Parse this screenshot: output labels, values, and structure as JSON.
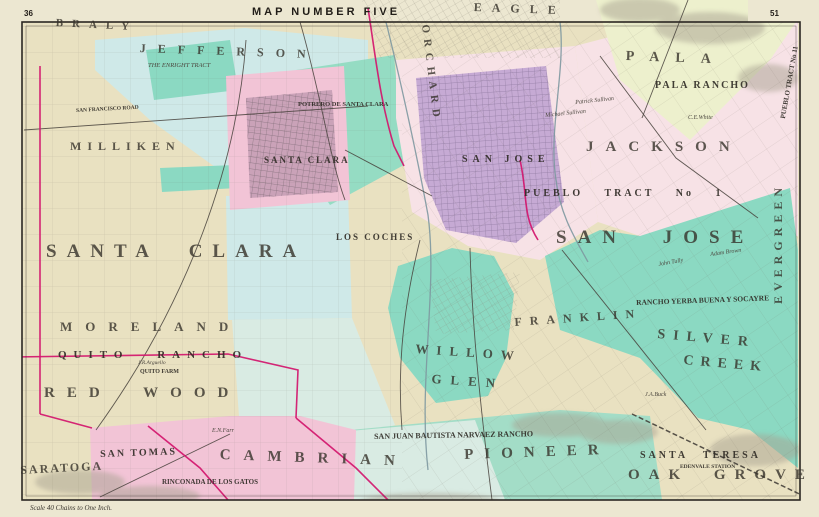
{
  "sheet": {
    "title": "MAP NUMBER FIVE",
    "page_number_left": "36",
    "page_number_right": "51",
    "scale_note": "Scale 40 Chains to One Inch."
  },
  "colors": {
    "margin": "#ece7d1",
    "cream": "#e9e1c1",
    "blue": "#cfe9e8",
    "blue2": "#d9ebe3",
    "teal": "#8bd9c2",
    "teal2": "#a3ddc7",
    "green": "#95dcc3",
    "palegreen": "#edf0cd",
    "pink": "#f2c4d6",
    "pinkpale": "#f7e2e6",
    "purple": "#c6aad4",
    "magenta": "#d3156d",
    "ink": "#2b2722",
    "road": "#45403a",
    "river": "#7d98a0",
    "hill": "#a8a291",
    "citygrid_pink": "#6d6068",
    "citygrid_purple": "#837095"
  },
  "labels": [
    {
      "id": "township-braly",
      "text": "BRALY",
      "x": 56,
      "y": 18,
      "s": 11,
      "ls": 9,
      "rot": 3,
      "cat": "twp"
    },
    {
      "id": "township-jefferson",
      "text": "JEFFERSON",
      "x": 140,
      "y": 42,
      "s": 12,
      "ls": 12,
      "rot": 2,
      "cat": "twp"
    },
    {
      "id": "township-eagle",
      "text": "EAGLE",
      "x": 474,
      "y": 1,
      "s": 12,
      "ls": 10,
      "rot": 2,
      "cat": "twp"
    },
    {
      "id": "township-pala",
      "text": "PALA",
      "x": 626,
      "y": 50,
      "s": 14,
      "ls": 16,
      "rot": 2,
      "cat": "twp"
    },
    {
      "id": "township-jackson",
      "text": "JACKSON",
      "x": 586,
      "y": 140,
      "s": 15,
      "ls": 12,
      "cat": "twp"
    },
    {
      "id": "township-milliken",
      "text": "MILLIKEN",
      "x": 70,
      "y": 140,
      "s": 12,
      "ls": 6,
      "cat": "twp"
    },
    {
      "id": "township-santa-clara",
      "text": "SANTA CLARA",
      "x": 46,
      "y": 242,
      "s": 19,
      "ls": 10,
      "ws": 16,
      "cat": "twp"
    },
    {
      "id": "township-san-jose",
      "text": "SAN JOSE",
      "x": 556,
      "y": 228,
      "s": 19,
      "ls": 11,
      "ws": 20,
      "cat": "twp"
    },
    {
      "id": "township-moreland",
      "text": "MORELAND",
      "x": 60,
      "y": 320,
      "s": 13,
      "ls": 13,
      "cat": "twp"
    },
    {
      "id": "township-redwood",
      "text": "RED WOOD",
      "x": 44,
      "y": 386,
      "s": 15,
      "ls": 12,
      "ws": 16,
      "cat": "twp"
    },
    {
      "id": "township-saratoga",
      "text": "SARATOGA",
      "x": 20,
      "y": 464,
      "s": 12,
      "ls": 2,
      "rot": -3,
      "cat": "twp"
    },
    {
      "id": "township-cambrian",
      "text": "CAMBRIAN",
      "x": 220,
      "y": 448,
      "s": 15,
      "ls": 13,
      "rot": 2,
      "cat": "twp"
    },
    {
      "id": "township-pioneer",
      "text": "PIONEER",
      "x": 464,
      "y": 448,
      "s": 15,
      "ls": 11,
      "rot": -2,
      "cat": "twp"
    },
    {
      "id": "township-oak-grove",
      "text": "OAK GROVE",
      "x": 628,
      "y": 468,
      "s": 15,
      "ls": 9,
      "ws": 12,
      "cat": "twp"
    },
    {
      "id": "township-silver",
      "text": "SILVER",
      "x": 658,
      "y": 328,
      "s": 14,
      "ls": 8,
      "rot": 5,
      "cat": "twp"
    },
    {
      "id": "township-creek",
      "text": "CREEK",
      "x": 684,
      "y": 354,
      "s": 14,
      "ls": 7,
      "rot": 5,
      "cat": "twp"
    },
    {
      "id": "township-willow",
      "text": "WILLOW",
      "x": 416,
      "y": 342,
      "s": 13,
      "ls": 8,
      "rot": 4,
      "cat": "twp"
    },
    {
      "id": "township-glen",
      "text": "GLEN",
      "x": 432,
      "y": 372,
      "s": 13,
      "ls": 9,
      "rot": 4,
      "cat": "twp"
    },
    {
      "id": "township-franklin",
      "text": "FRANKLIN",
      "x": 514,
      "y": 316,
      "s": 12,
      "ls": 8,
      "rot": -4,
      "cat": "twp"
    },
    {
      "id": "township-evergreen",
      "text": "EVERGREEN",
      "x": 772,
      "y": 304,
      "s": 12,
      "ls": 5,
      "rot": -90,
      "cat": "twp"
    },
    {
      "id": "district-orchard",
      "text": "ORCHARD",
      "x": 430,
      "y": 24,
      "s": 11,
      "ls": 6,
      "rot": 83,
      "cat": "twp"
    },
    {
      "id": "district-quito-rancho",
      "text": "QUITO RANCHO",
      "x": 58,
      "y": 350,
      "s": 11,
      "ls": 7,
      "ws": 18,
      "cat": "dist"
    },
    {
      "id": "district-san-tomas",
      "text": "SAN TOMAS",
      "x": 100,
      "y": 450,
      "s": 10,
      "ls": 2,
      "rot": -2,
      "cat": "dist"
    },
    {
      "id": "district-rinconada",
      "text": "RINCONADA DE LOS GATOS",
      "x": 162,
      "y": 479,
      "s": 7,
      "cat": "dist"
    },
    {
      "id": "district-narvaez",
      "text": "SAN JUAN BAUTISTA NARVAEZ RANCHO",
      "x": 374,
      "y": 433,
      "s": 8,
      "rot": -1,
      "cat": "dist"
    },
    {
      "id": "district-santa-teresa",
      "text": "SANTA TERESA",
      "x": 640,
      "y": 451,
      "s": 10,
      "ls": 3,
      "ws": 10,
      "cat": "dist"
    },
    {
      "id": "district-edenvale-station",
      "text": "EDENVALE STATION",
      "x": 680,
      "y": 465,
      "s": 5.5,
      "cat": "dist"
    },
    {
      "id": "district-pala-rancho",
      "text": "PALA  RANCHO",
      "x": 655,
      "y": 81,
      "s": 10,
      "ls": 2,
      "cat": "dist"
    },
    {
      "id": "district-yerba-buena",
      "text": "RANCHO YERBA BUENA Y SOCAYRE",
      "x": 636,
      "y": 299,
      "s": 7.5,
      "rot": -2,
      "cat": "dist"
    },
    {
      "id": "district-pueblo-tract-1",
      "text": "PUEBLO   TRACT   No 1",
      "x": 524,
      "y": 189,
      "s": 10,
      "ls": 3,
      "ws": 16,
      "cat": "dist"
    },
    {
      "id": "district-los-coches",
      "text": "LOS COCHES",
      "x": 336,
      "y": 233,
      "s": 9,
      "ls": 2,
      "cat": "dist"
    },
    {
      "id": "district-potrero",
      "text": "POTRERO DE SANTA CLARA",
      "x": 298,
      "y": 102,
      "s": 6.5,
      "cat": "dist"
    },
    {
      "id": "city-santa-clara",
      "text": "SANTA CLARA",
      "x": 264,
      "y": 156,
      "s": 9,
      "ls": 2,
      "cat": "dist"
    },
    {
      "id": "city-san-jose",
      "text": "SAN JOSE",
      "x": 462,
      "y": 155,
      "s": 10,
      "ls": 5,
      "cat": "dist"
    },
    {
      "id": "tract-enright",
      "text": "THE ENRIGHT TRACT",
      "x": 148,
      "y": 63,
      "s": 6.5,
      "cat": "minor"
    },
    {
      "id": "tract-pueblo-11",
      "text": "PUEBLO TRACT No 11",
      "x": 780,
      "y": 118,
      "s": 7,
      "rot": -80,
      "cat": "dist"
    },
    {
      "id": "road-san-francisco",
      "text": "SAN FRANCISCO ROAD",
      "x": 76,
      "y": 109,
      "s": 5.5,
      "rot": -3,
      "cat": "dist"
    },
    {
      "id": "farm-quito",
      "text": "QUITO FARM",
      "x": 140,
      "y": 369,
      "s": 6,
      "cat": "dist"
    },
    {
      "id": "parcel-arguello",
      "text": "J.R.Arguello",
      "x": 138,
      "y": 361,
      "s": 5.5,
      "cat": "minor"
    },
    {
      "id": "parcel-ce-white",
      "text": "C.E.White",
      "x": 688,
      "y": 115,
      "s": 6,
      "cat": "minor"
    },
    {
      "id": "parcel-patrick-sullivan",
      "text": "Patrick Sullivan",
      "x": 575,
      "y": 100,
      "s": 6,
      "rot": -6,
      "cat": "minor"
    },
    {
      "id": "parcel-michael-sullivan",
      "text": "Michael Sullivan",
      "x": 545,
      "y": 113,
      "s": 6,
      "rot": -6,
      "cat": "minor"
    },
    {
      "id": "parcel-john-tully",
      "text": "John Tully",
      "x": 658,
      "y": 262,
      "s": 6,
      "rot": -10,
      "cat": "minor"
    },
    {
      "id": "parcel-adam-brown",
      "text": "Adam Brown",
      "x": 710,
      "y": 252,
      "s": 6,
      "rot": -8,
      "cat": "minor"
    },
    {
      "id": "parcel-ja-buck",
      "text": "J.A.Buck",
      "x": 645,
      "y": 392,
      "s": 6,
      "cat": "minor"
    },
    {
      "id": "parcel-en-farr",
      "text": "E.N.Farr",
      "x": 212,
      "y": 428,
      "s": 6,
      "cat": "minor"
    }
  ]
}
